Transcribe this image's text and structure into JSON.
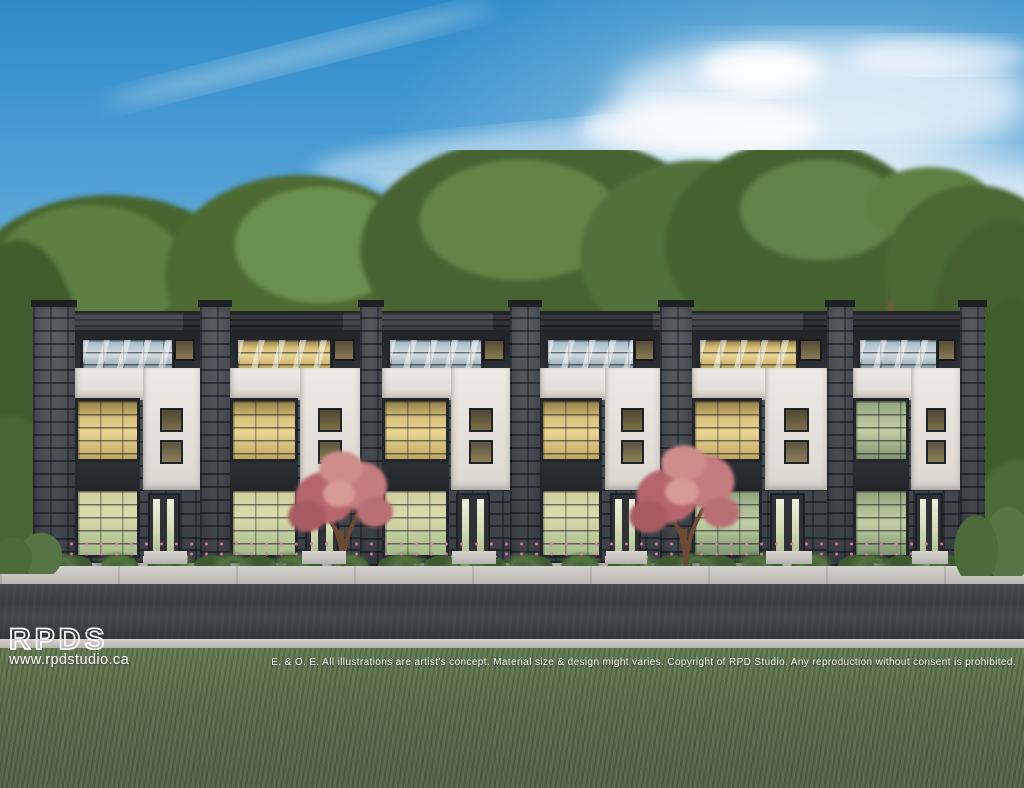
{
  "watermark": {
    "logo": "RPDS",
    "website": "www.rpdstudio.ca"
  },
  "disclaimer": "E. & O. E. All illustrations are artist's concept. Material size & design might varies. Copyright of RPD Studio. Any reproduction without consent is prohibited.",
  "scene": {
    "subject": "Street-front architectural rendering of a row of six three-storey modern townhomes with grey stacked-stone piers, white stucco panels, black-framed lit windows, flowering shrubs and two pink ornamental trees, fronted by a sidewalk, asphalt road and lawn under a blue sky with wispy clouds and a backdrop of mature green trees",
    "units": [
      {
        "id": "1",
        "third_floor": "cool",
        "second_floor": "warm",
        "ground_floor": "warmgreen"
      },
      {
        "id": "2",
        "third_floor": "warm",
        "second_floor": "warm",
        "ground_floor": "warmgreen"
      },
      {
        "id": "3",
        "third_floor": "cool",
        "second_floor": "warm",
        "ground_floor": "warmgreen"
      },
      {
        "id": "4",
        "third_floor": "cool",
        "second_floor": "warm",
        "ground_floor": "warmgreen"
      },
      {
        "id": "5",
        "third_floor": "warm",
        "second_floor": "warm",
        "ground_floor": "green"
      },
      {
        "id": "6",
        "third_floor": "cool",
        "second_floor": "green",
        "ground_floor": "green"
      }
    ],
    "palette": {
      "sky_top": "#2e8bc8",
      "sky_horizon": "#cfe8f4",
      "tree_foliage": "#55743f",
      "stone_grey": "#4b4f55",
      "stucco_white": "#e8e5df",
      "window_glow": "#e0cc8a",
      "blossom_pink": "#c0767c",
      "road_asphalt": "#3a3c3f",
      "grass_green": "#5a6f4c",
      "watermark_text": "#ffffff"
    }
  }
}
